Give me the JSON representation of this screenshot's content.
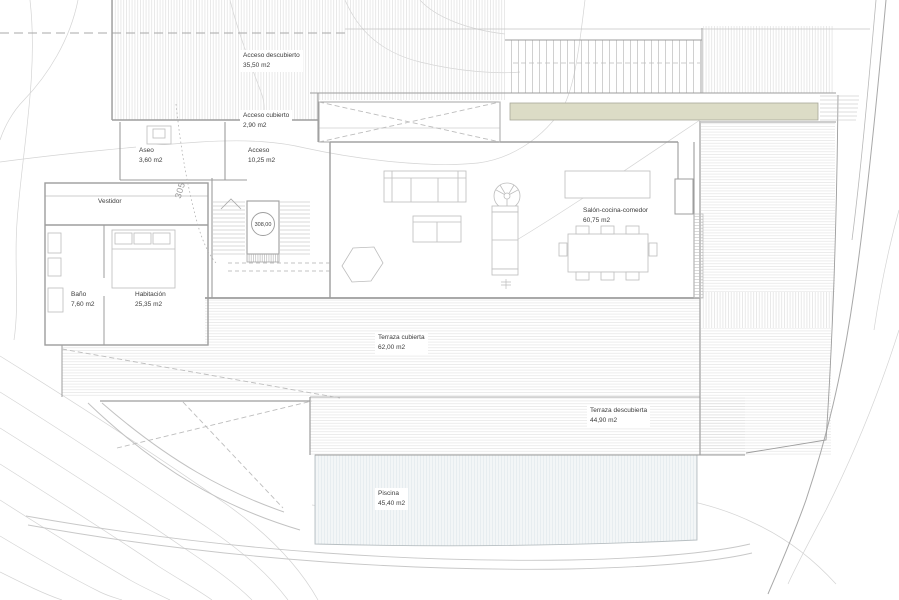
{
  "plan": {
    "labels": {
      "acceso_descubierto": {
        "name": "Acceso descubierto",
        "area": "35,50 m2"
      },
      "acceso_cubierto": {
        "name": "Acceso cubierto",
        "area": "2,90 m2"
      },
      "aseo": {
        "name": "Aseo",
        "area": "3,60 m2"
      },
      "acceso": {
        "name": "Acceso",
        "area": "10,25 m2"
      },
      "vestidor": {
        "name": "Vestidor",
        "area": ""
      },
      "bano": {
        "name": "Baño",
        "area": "7,60 m2"
      },
      "habitacion": {
        "name": "Habitación",
        "area": "25,35 m2"
      },
      "salon": {
        "name": "Salón-cocina-comedor",
        "area": "60,75 m2"
      },
      "terraza_cubierta": {
        "name": "Terraza cubierta",
        "area": "62,00 m2"
      },
      "terraza_descubierta": {
        "name": "Terraza descubierta",
        "area": "44,90 m2"
      },
      "piscina": {
        "name": "Piscina",
        "area": "45,40 m2"
      }
    },
    "level_marker": "308,00",
    "contour_label": "305",
    "colors": {
      "planter_fill": "#dcdcc6",
      "pool_fill": "#f3f6f7",
      "line": "#b8b8b8",
      "text": "#3c3c3c"
    }
  }
}
